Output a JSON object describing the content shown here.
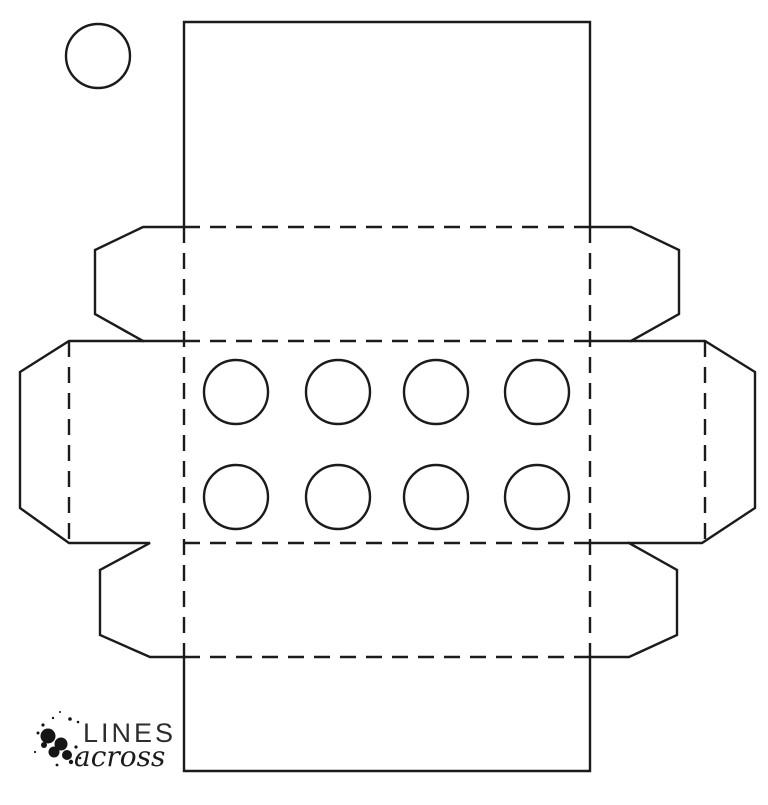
{
  "page": {
    "background": "#ffffff",
    "kind": "printable box template"
  },
  "style": {
    "stroke": "#1b1b1b",
    "stroke_width": 2.4,
    "dash": "16 10",
    "logo_text_color": "#2d2d2d",
    "logo_script_color": "#1b1b1b",
    "splatter_color": "#151515"
  },
  "logo": {
    "line1": "LINES",
    "line2": "across"
  },
  "diagram": {
    "cut_polylines": [
      [
        [
          184,
          227
        ],
        [
          184,
          22
        ],
        [
          590,
          22
        ],
        [
          590,
          227
        ]
      ],
      [
        [
          184,
          657
        ],
        [
          184,
          771
        ],
        [
          590,
          771
        ],
        [
          590,
          657
        ]
      ],
      [
        [
          184,
          227
        ],
        [
          143,
          227
        ],
        [
          95,
          250
        ],
        [
          95,
          314
        ],
        [
          143,
          341
        ]
      ],
      [
        [
          590,
          227
        ],
        [
          631,
          227
        ],
        [
          679,
          250
        ],
        [
          679,
          314
        ],
        [
          631,
          341
        ]
      ],
      [
        [
          184,
          341
        ],
        [
          69,
          341
        ],
        [
          20,
          372
        ],
        [
          20,
          508
        ],
        [
          69,
          543
        ],
        [
          150,
          543
        ],
        [
          100,
          570
        ],
        [
          100,
          635
        ],
        [
          150,
          657
        ],
        [
          184,
          657
        ]
      ],
      [
        [
          590,
          341
        ],
        [
          705,
          341
        ],
        [
          755,
          372
        ],
        [
          755,
          508
        ],
        [
          702,
          543
        ],
        [
          590,
          543
        ]
      ],
      [
        [
          629,
          543
        ],
        [
          677,
          570
        ],
        [
          677,
          635
        ],
        [
          629,
          657
        ],
        [
          590,
          657
        ]
      ]
    ],
    "fold_lines": [
      [
        [
          184,
          227
        ],
        [
          590,
          227
        ]
      ],
      [
        [
          184,
          341
        ],
        [
          590,
          341
        ]
      ],
      [
        [
          184,
          543
        ],
        [
          590,
          543
        ]
      ],
      [
        [
          184,
          657
        ],
        [
          590,
          657
        ]
      ],
      [
        [
          184,
          227
        ],
        [
          184,
          657
        ]
      ],
      [
        [
          590,
          227
        ],
        [
          590,
          657
        ]
      ],
      [
        [
          69,
          341
        ],
        [
          69,
          543
        ]
      ],
      [
        [
          705,
          341
        ],
        [
          705,
          543
        ]
      ]
    ],
    "punch_circle": {
      "cx": 98,
      "cy": 56,
      "r": 32
    },
    "stud_radius": 32,
    "stud_circles": [
      {
        "cx": 236,
        "cy": 392
      },
      {
        "cx": 338,
        "cy": 392
      },
      {
        "cx": 436,
        "cy": 392
      },
      {
        "cx": 537,
        "cy": 392
      },
      {
        "cx": 236,
        "cy": 497
      },
      {
        "cx": 338,
        "cy": 497
      },
      {
        "cx": 436,
        "cy": 497
      },
      {
        "cx": 537,
        "cy": 497
      }
    ]
  },
  "logo_art": {
    "splatter_dots": [
      {
        "cx": 48,
        "cy": 736,
        "r": 7.5
      },
      {
        "cx": 61,
        "cy": 744,
        "r": 6.5
      },
      {
        "cx": 54,
        "cy": 752,
        "r": 5.5
      },
      {
        "cx": 67,
        "cy": 755,
        "r": 5
      },
      {
        "cx": 44,
        "cy": 745,
        "r": 3
      },
      {
        "cx": 71,
        "cy": 762,
        "r": 2.2
      },
      {
        "cx": 43,
        "cy": 725,
        "r": 1.6
      },
      {
        "cx": 53,
        "cy": 718,
        "r": 1.2
      },
      {
        "cx": 70,
        "cy": 719,
        "r": 1.8
      },
      {
        "cx": 78,
        "cy": 722,
        "r": 1.3
      },
      {
        "cx": 38,
        "cy": 733,
        "r": 1.5
      },
      {
        "cx": 76,
        "cy": 747,
        "r": 1.6
      },
      {
        "cx": 60,
        "cy": 712,
        "r": 1
      },
      {
        "cx": 80,
        "cy": 758,
        "r": 1.3
      },
      {
        "cx": 35,
        "cy": 752,
        "r": 1.1
      },
      {
        "cx": 57,
        "cy": 765,
        "r": 1.4
      }
    ],
    "text1_pos": {
      "x": 83,
      "y": 742,
      "size": 27
    },
    "text2_pos": {
      "x": 74,
      "y": 766,
      "size": 28
    }
  }
}
